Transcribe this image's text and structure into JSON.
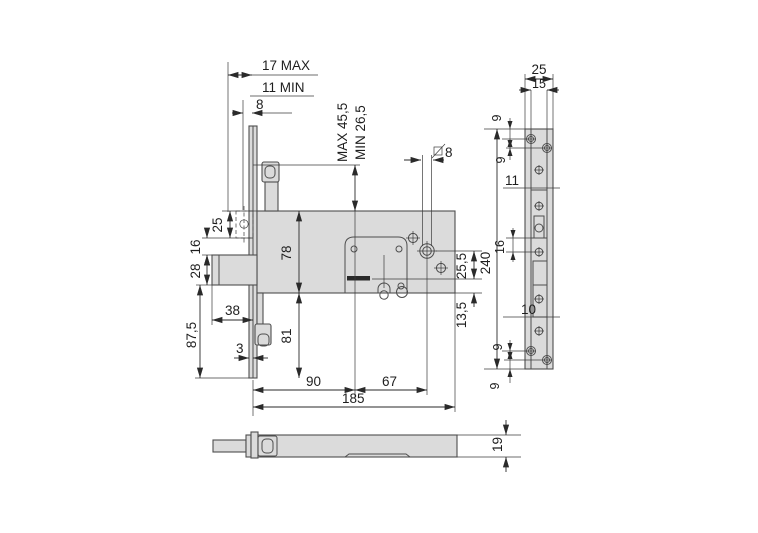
{
  "meta": {
    "type": "technical drawing, mortise gate lock, three orthographic views",
    "colors": {
      "background": "#ffffff",
      "part_fill": "#dbdbdb",
      "outline": "#4e4e4e",
      "dimension": "#2a2a2a"
    },
    "icons": {
      "spindle_symbol_icon": "square-slash",
      "screw_icon": "circle-cross",
      "hole_icon": "circle-crosshair"
    }
  },
  "front_view": {
    "dim_backset_max": "17 MAX",
    "dim_backset_min": "11 MIN",
    "dim_faceplate_offset": "8",
    "dim_adjust_max": "MAX 45,5",
    "dim_adjust_min": "MIN 26,5",
    "dim_spindle_hole": "8",
    "dim_latch_height": "25",
    "dim_latch_to_bolt": "16",
    "dim_bolt_height": "28",
    "dim_lower_height": "87,5",
    "dim_bolt_throw": "38",
    "dim_faceplate_thickness": "3",
    "dim_body_height": "78",
    "dim_below_body": "81",
    "dim_backset": "90",
    "dim_center_to_hole": "67",
    "dim_body_length": "185",
    "dim_hole_to_axis": "25,5",
    "dim_axis_to_bottom": "13,5",
    "dim_plate_height": "240"
  },
  "side_view": {
    "dim_width": "25",
    "dim_inner_width": "15",
    "dim_screw_top_1": "9",
    "dim_screw_top_2": "9",
    "dim_top_section": "11",
    "dim_mid_section": "16",
    "dim_lower_section": "10",
    "dim_screw_bottom_1": "9",
    "dim_screw_bottom_2": "9"
  },
  "bottom_view": {
    "dim_thickness": "19"
  }
}
